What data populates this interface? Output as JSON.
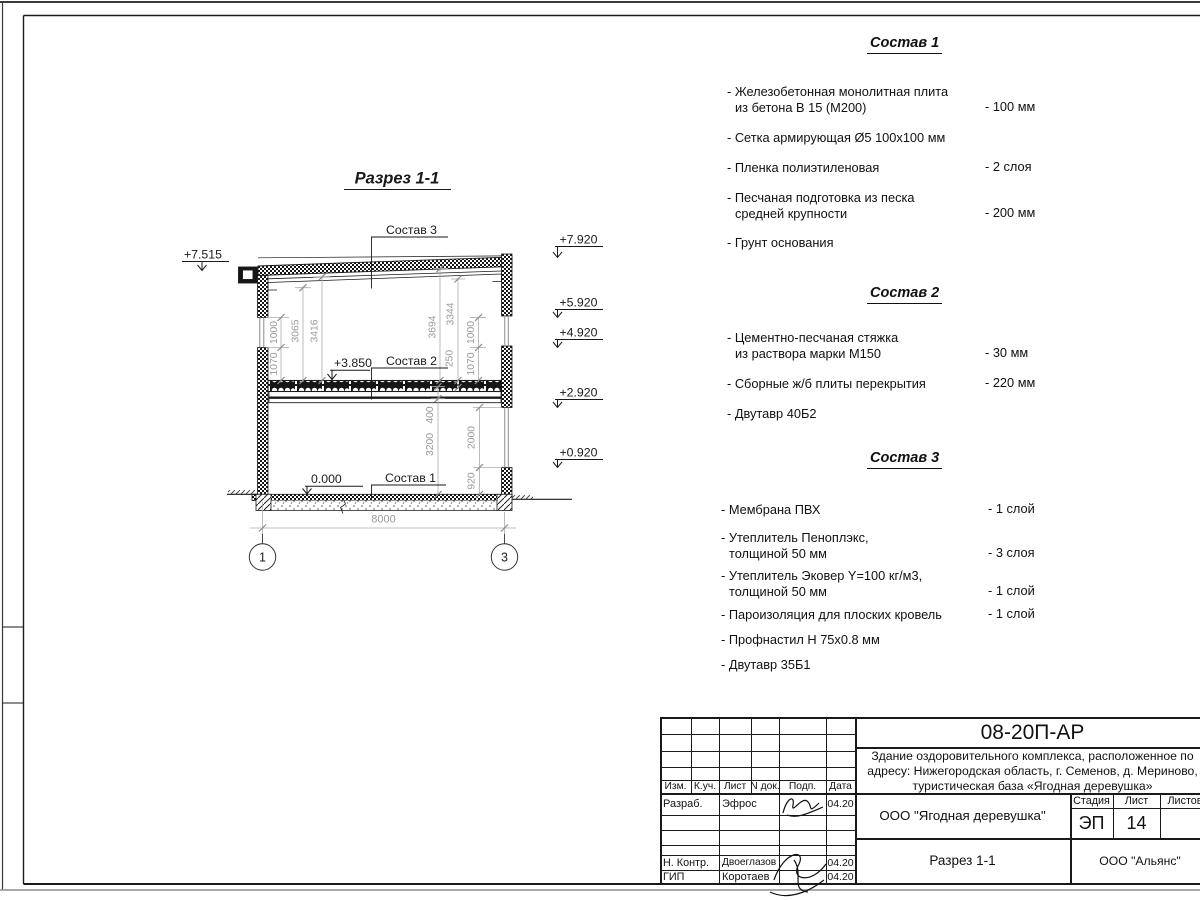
{
  "drawing": {
    "title": "Разрез 1-1",
    "axes": [
      "1",
      "3"
    ],
    "labels": {
      "s1": "Состав 1",
      "s2": "Состав 2",
      "s3": "Состав 3"
    },
    "elevations": {
      "right": [
        "+7.920",
        "+5.920",
        "+4.920",
        "+2.920",
        "+0.920"
      ],
      "eave": "+7.515",
      "floor2": "+3.850",
      "zero": "0.000"
    },
    "dims": {
      "left": [
        "1000",
        "1070",
        "3065",
        "3416"
      ],
      "right": [
        "3694",
        "3344",
        "250",
        "1000",
        "1070"
      ],
      "lower": [
        "400",
        "3200",
        "2000",
        "920"
      ],
      "span": "8000"
    }
  },
  "compositions": [
    {
      "title": "Состав 1",
      "items": [
        {
          "l1": "- Железобетонная  монолитная плита",
          "l2": "из бетона В 15 (М200)",
          "v": "- 100 мм"
        },
        {
          "l1": "- Сетка армирующая Ø5 100х100 мм"
        },
        {
          "l1": "- Пленка полиэтиленовая",
          "v": "-  2 слоя"
        },
        {
          "l1": "- Песчаная подготовка из песка",
          "l2": "средней крупности",
          "v": "- 200 мм"
        },
        {
          "l1": "- Грунт основания"
        }
      ]
    },
    {
      "title": "Состав 2",
      "items": [
        {
          "l1": "- Цементно-песчаная стяжка",
          "l2": "из раствора марки М150",
          "v": "- 30 мм"
        },
        {
          "l1": "- Сборные ж/б плиты перекрытия",
          "v": "- 220 мм"
        },
        {
          "l1": "- Двутавр 40Б2"
        }
      ]
    },
    {
      "title": "Состав 3",
      "items": [
        {
          "l1": "- Мембрана ПВХ",
          "v": "- 1 слой"
        },
        {
          "l1": "- Утеплитель Пеноплэкс,",
          "l2": "толщиной 50 мм",
          "v": "- 3 слоя"
        },
        {
          "l1": "- Утеплитель Эковер Y=100 кг/м3,",
          "l2": "толщиной 50 мм",
          "v": "- 1 слой"
        },
        {
          "l1": "- Пароизоляция для плоских кровель",
          "v": "- 1 слой"
        },
        {
          "l1": "- Профнастил Н 75х0.8 мм"
        },
        {
          "l1": "- Двутавр 35Б1"
        }
      ]
    }
  ],
  "titleblock": {
    "code": "08-20П-АР",
    "project": [
      "Здание оздоровительного комплекса, расположенное по",
      "адресу: Нижегородская область, г. Семенов, д. Мериново,",
      "туристическая база «Ягодная деревушка»"
    ],
    "client": "ООО \"Ягодная деревушка\"",
    "stage_label": "Стадия",
    "sheet_label": "Лист",
    "sheets_label": "Листов",
    "stage": "ЭП",
    "sheet_no": "14",
    "view_title": "Разрез 1-1",
    "org": "ООО \"Альянс\"",
    "columns": [
      "Изм.",
      "К.уч.",
      "Лист",
      "N док.",
      "Подп.",
      "Дата"
    ],
    "rows": [
      {
        "role": "Разраб.",
        "name": "Эфрос",
        "date": "04.20"
      },
      {
        "role": "Н. Контр.",
        "name": "Двоеглазов",
        "date": "04.20"
      },
      {
        "role": "ГИП",
        "name": "Коротаев",
        "date": "04.20"
      }
    ]
  }
}
